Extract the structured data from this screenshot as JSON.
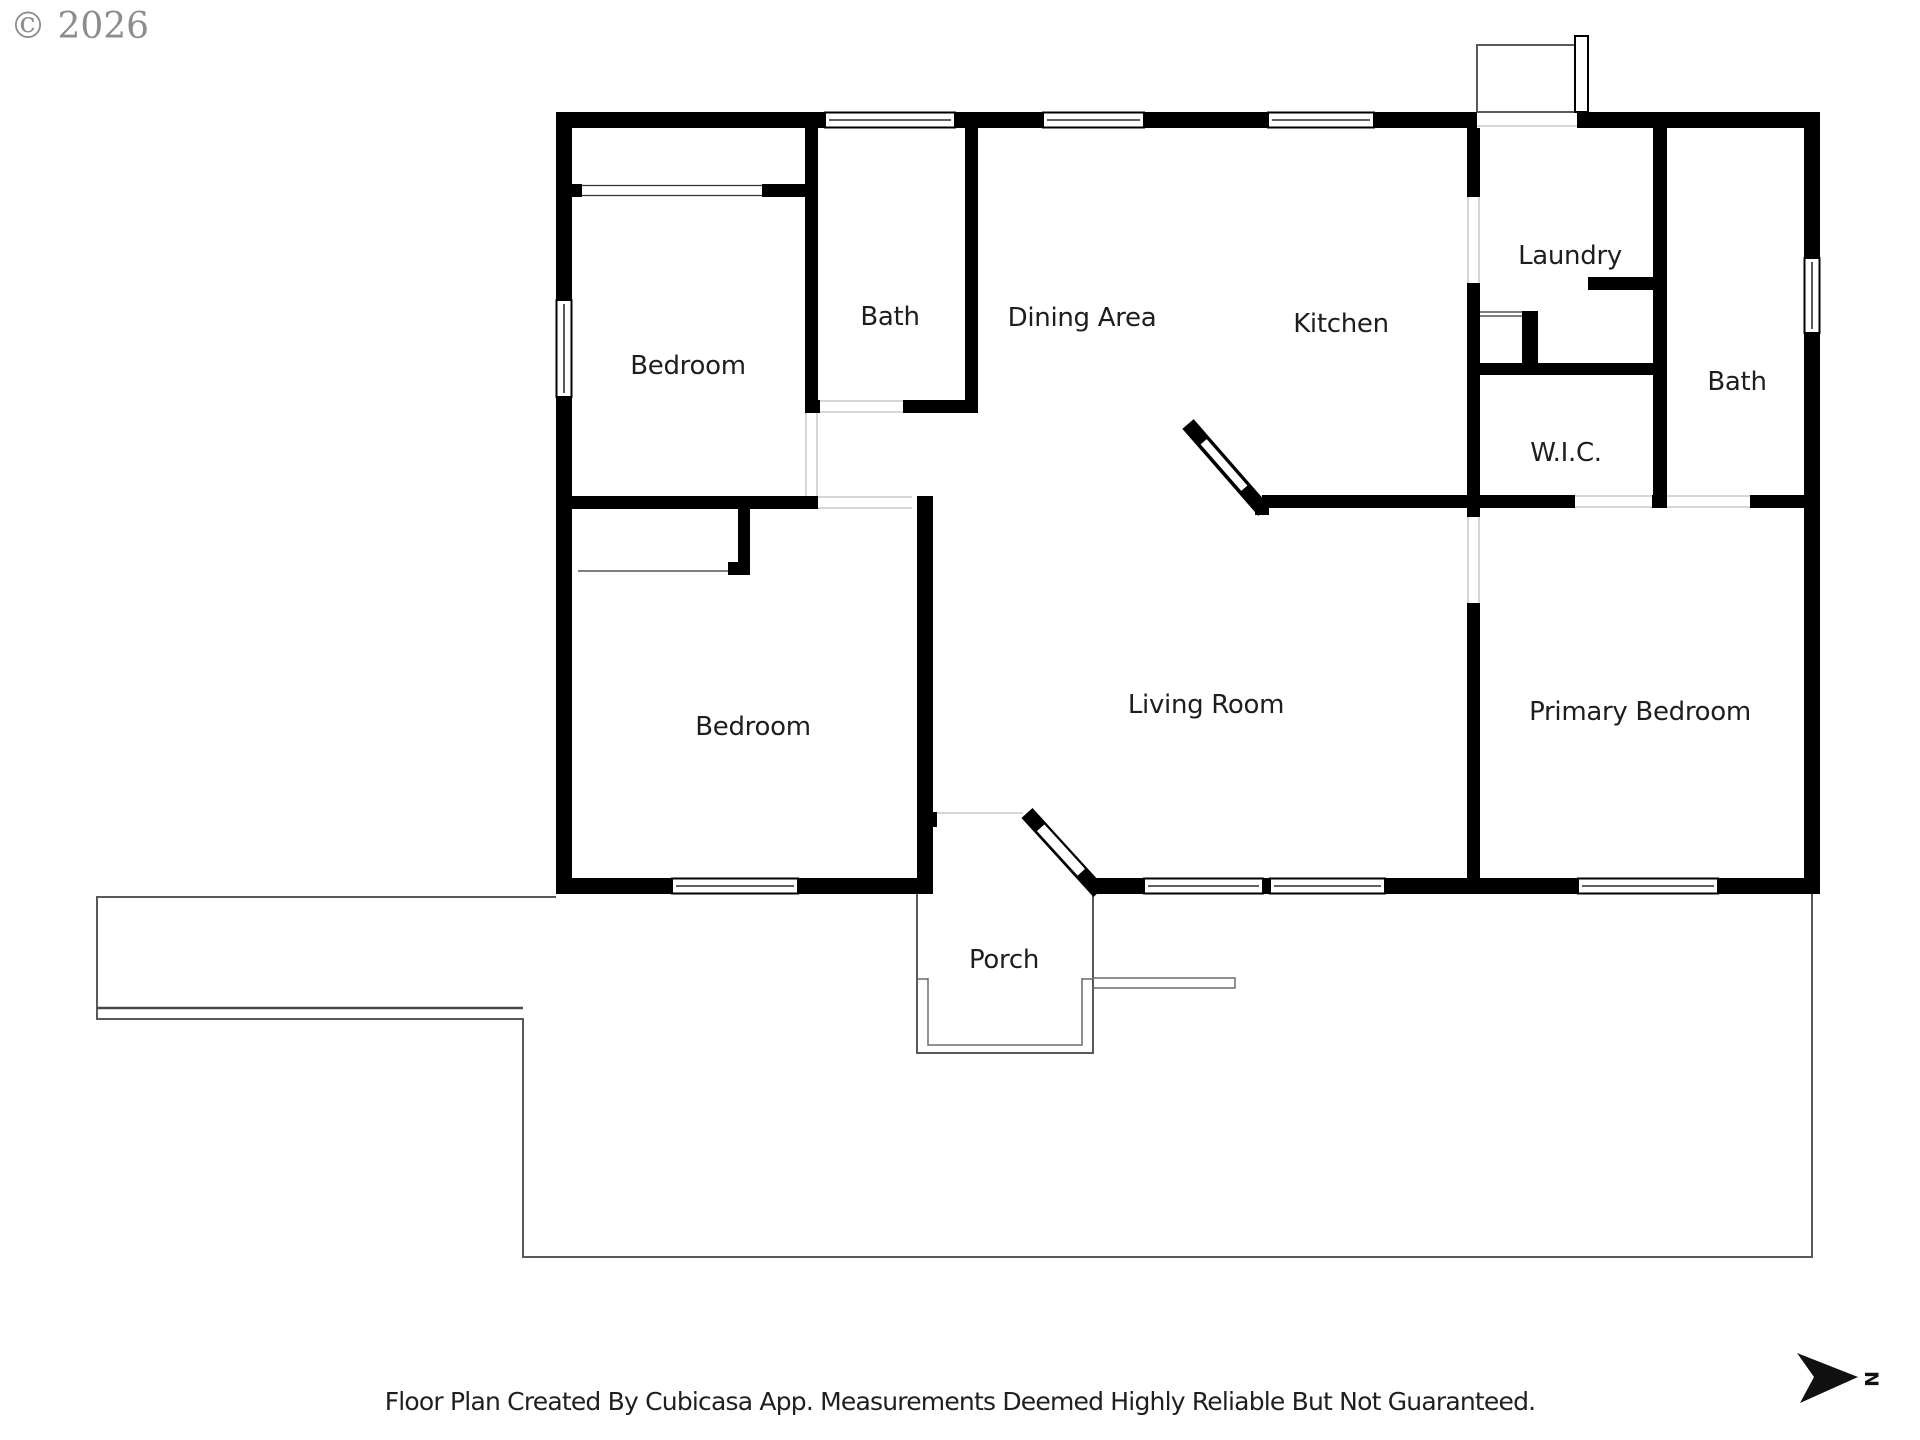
{
  "copyright": "© 2026",
  "compass": {
    "north_label": "N"
  },
  "footer": {
    "disclaimer": "Floor Plan Created By Cubicasa App. Measurements Deemed Highly Reliable But Not Guaranteed."
  },
  "rooms": {
    "bedroom_top_left": {
      "label": "Bedroom"
    },
    "bath_top": {
      "label": "Bath"
    },
    "dining_area": {
      "label": "Dining Area"
    },
    "kitchen": {
      "label": "Kitchen"
    },
    "laundry": {
      "label": "Laundry"
    },
    "bath_right": {
      "label": "Bath"
    },
    "wic": {
      "label": "W.I.C."
    },
    "bedroom_bottom_left": {
      "label": "Bedroom"
    },
    "living_room": {
      "label": "Living Room"
    },
    "primary_bedroom": {
      "label": "Primary Bedroom"
    },
    "porch": {
      "label": "Porch"
    }
  },
  "colors": {
    "wall": "#000000",
    "deck_outline": "#58595b",
    "label_text": "#1e1e1e",
    "copyright_gray": "#8d8d8d"
  }
}
